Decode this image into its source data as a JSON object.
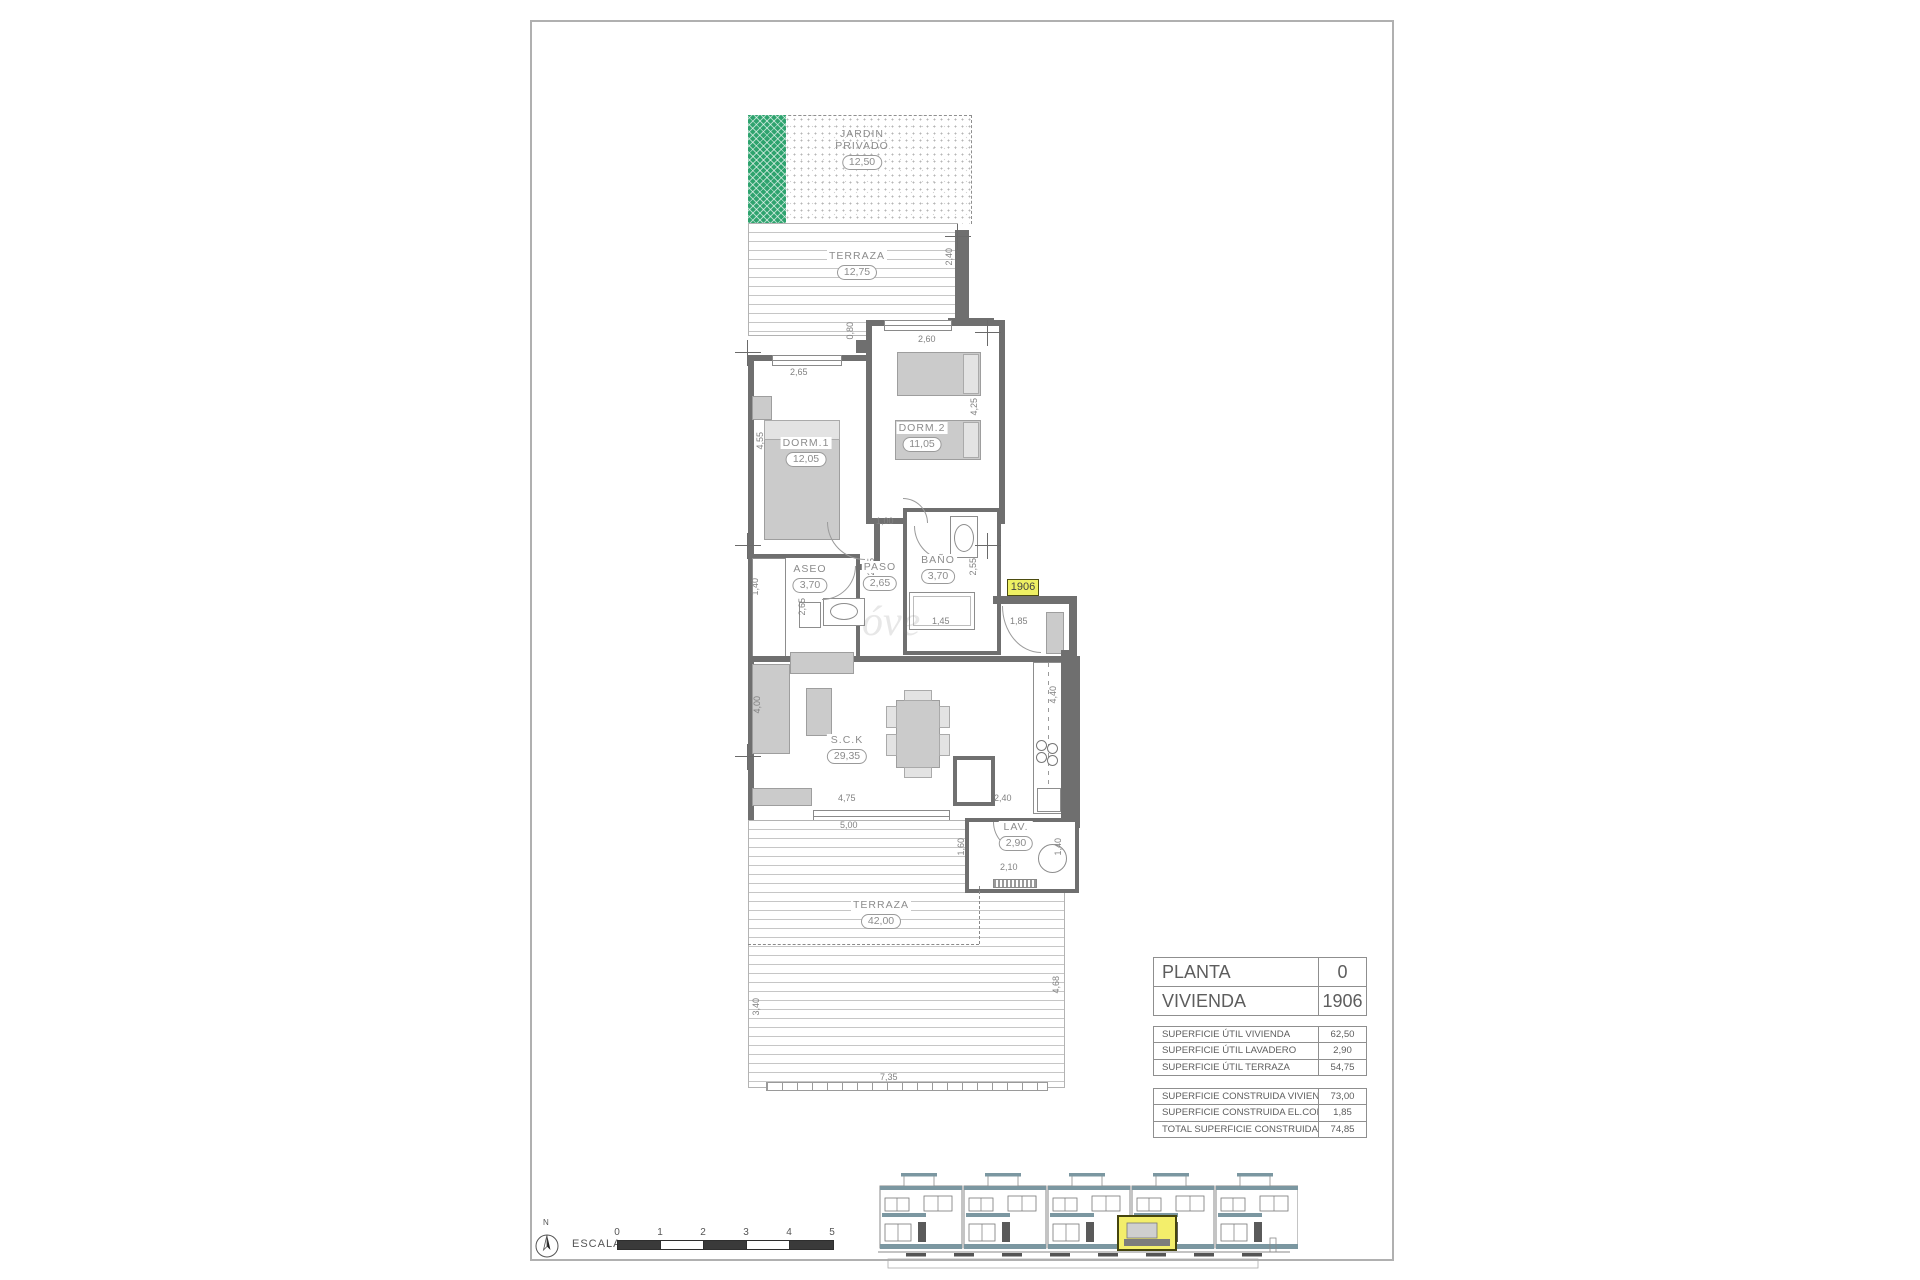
{
  "plan": {
    "garden": {
      "line1": "JARDIN",
      "line2": "PRIVADO",
      "area": "12,50"
    },
    "terraza_top": {
      "name": "TERRAZA",
      "area": "12,75"
    },
    "dorm1": {
      "name": "DORM.1",
      "area": "12,05"
    },
    "dorm2": {
      "name": "DORM.2",
      "area": "11,05"
    },
    "aseo": {
      "name": "ASEO",
      "area": "3,70"
    },
    "paso": {
      "name": "PASO",
      "area": "2,65"
    },
    "bano": {
      "name": "BAÑO",
      "area": "3,70"
    },
    "sck": {
      "name": "S.C.K",
      "area": "29,35"
    },
    "lav": {
      "name": "LAV.",
      "area": "2,90"
    },
    "terraza_bottom": {
      "name": "TERRAZA",
      "area": "42,00"
    },
    "unit_badge": "1906",
    "watermark": "óve",
    "dims": {
      "terraza_right": "2,40",
      "step": "0,80",
      "dorm2_top": "2,60",
      "dorm1_top": "2,65",
      "dorm1_left": "4,55",
      "dorm2_right": "4,25",
      "hall": "1,00",
      "aseo_left": "1,40",
      "paso_height": "2,65",
      "bano_right": "2,55",
      "aseo_bottom": "2,65",
      "bano_bottom": "1,45",
      "entry": "1,85",
      "sck_left": "4,00",
      "sck_width": "4,75",
      "terraza_width": "5,00",
      "sck_right": "2,40",
      "kitchen": "4,40",
      "lav_bottom": "2,10",
      "lav_left": "1,60",
      "lav_right": "1,40",
      "terraza_b_left": "3,40",
      "terraza_b_right": "4,68",
      "terraza_b_width": "7,35"
    }
  },
  "titleblock": {
    "main": [
      {
        "label": "PLANTA",
        "value": "0"
      },
      {
        "label": "VIVIENDA",
        "value": "1906"
      }
    ],
    "util": [
      {
        "label": "SUPERFICIE ÚTIL VIVIENDA",
        "value": "62,50"
      },
      {
        "label": "SUPERFICIE ÚTIL LAVADERO",
        "value": "2,90"
      },
      {
        "label": "SUPERFICIE ÚTIL TERRAZA",
        "value": "54,75"
      }
    ],
    "construida": [
      {
        "label": "SUPERFICIE CONSTRUIDA VIVIENDA",
        "value": "73,00"
      },
      {
        "label": "SUPERFICIE CONSTRUIDA EL.COMUNES",
        "value": "1,85"
      },
      {
        "label": "TOTAL SUPERFICIE CONSTRUIDA",
        "value": "74,85"
      }
    ]
  },
  "footer": {
    "scale_label": "ESCALA :",
    "ticks": [
      "0",
      "1",
      "2",
      "3",
      "4",
      "5"
    ],
    "north": "N"
  }
}
